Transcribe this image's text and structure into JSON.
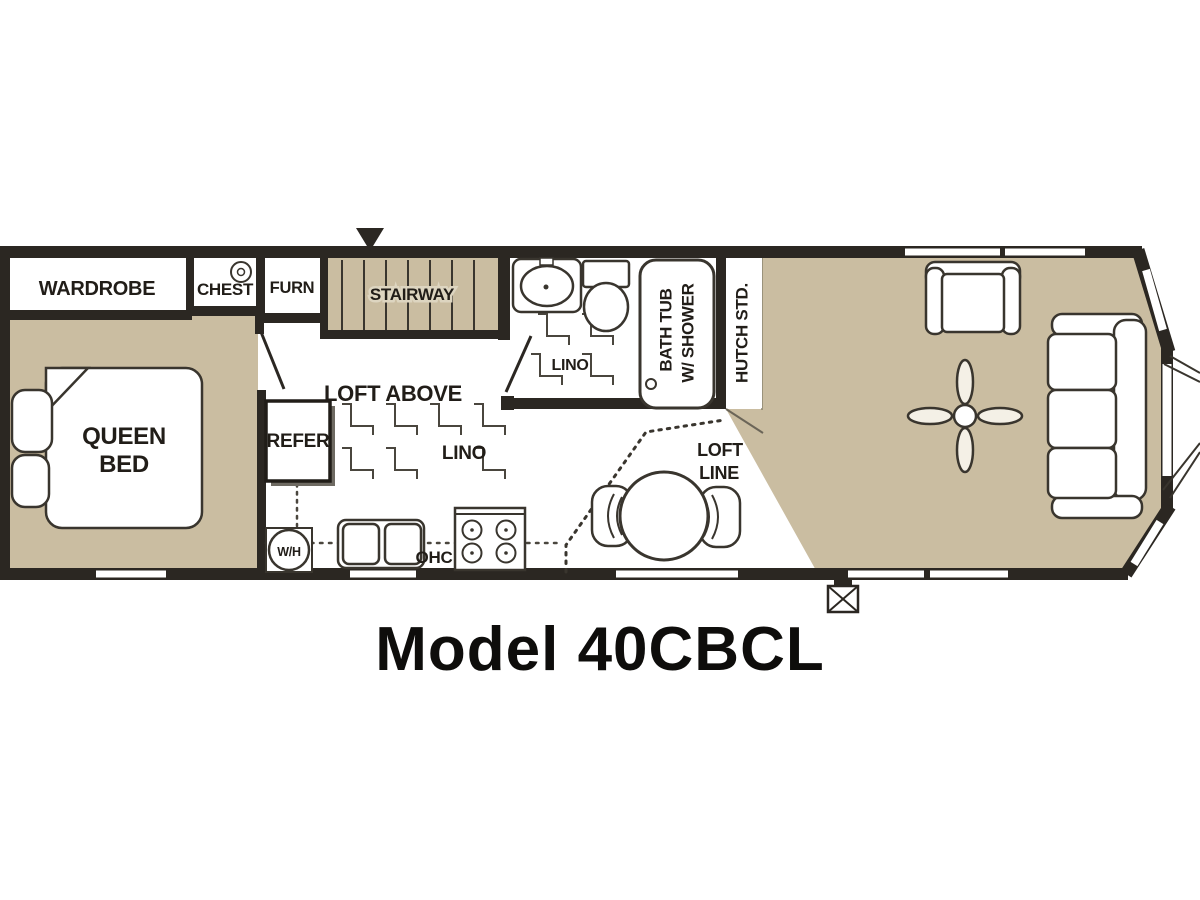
{
  "title": "Model 40CBCL",
  "colors": {
    "floor": "#cabda1",
    "wall": "#2b2722",
    "line": "#39352e",
    "background": "#ffffff"
  },
  "labels": {
    "wardrobe": "WARDROBE",
    "chest": "CHEST",
    "furnace": "FURN",
    "stairway": "STAIRWAY",
    "queen_bed": [
      "QUEEN",
      "BED"
    ],
    "refrigerator": "REFER",
    "loft_above": "LOFT ABOVE",
    "lino_kitchen": "LINO",
    "lino_bath": "LINO",
    "bath_tub": [
      "BATH TUB",
      "W/ SHOWER"
    ],
    "hutch": "HUTCH STD.",
    "water_heater": "W/H",
    "overhead_cabinet": "OHC",
    "loft_line": [
      "LOFT",
      "LINE"
    ]
  }
}
